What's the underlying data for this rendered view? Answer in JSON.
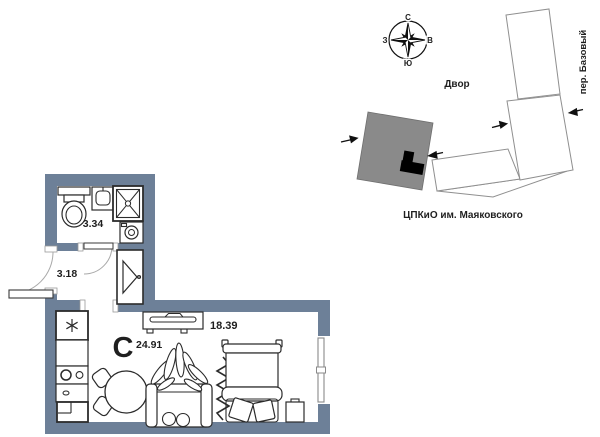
{
  "floor_plan": {
    "type_letter": "С",
    "areas": {
      "bathroom": "3.34",
      "hallway": "3.18",
      "studio": "24.91",
      "living": "18.39"
    }
  },
  "site_plan": {
    "compass": {
      "n": "С",
      "s": "Ю",
      "w": "З",
      "e": "В"
    },
    "courtyard_label": "Двор",
    "street_label": "пер. Базовый",
    "park_label": "ЦПКиО им. Маяковского"
  },
  "colors": {
    "wall": "#6d8098",
    "type_letter": "#6d8098",
    "highlight_building": "#8a8a8a",
    "unit_marker": "#000000",
    "building_outline": "#8f8f8f"
  }
}
